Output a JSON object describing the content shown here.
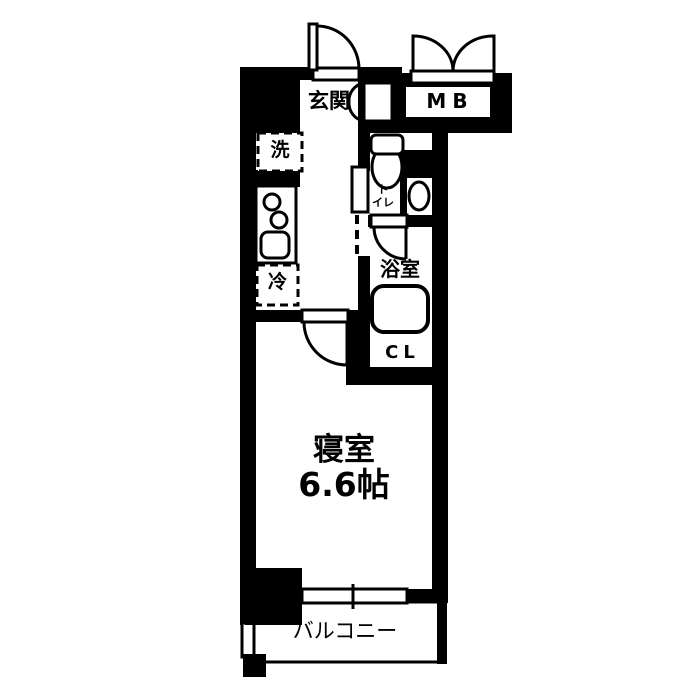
{
  "floorplan": {
    "type": "japanese-apartment-1k",
    "colors": {
      "wall": "#000000",
      "floor": "#ffffff",
      "line": "#000000"
    },
    "rooms": {
      "entrance": {
        "label": "玄関"
      },
      "meter_box": {
        "label": "MB"
      },
      "washer": {
        "label": "洗"
      },
      "fridge": {
        "label": "冷"
      },
      "toilet": {
        "label": "ト\nイレ"
      },
      "bathroom": {
        "label": "浴室"
      },
      "closet": {
        "label": "CL"
      },
      "bedroom": {
        "label": "寝室",
        "size": "6.6帖"
      },
      "balcony": {
        "label": "バルコニー"
      }
    },
    "fixtures": [
      "entrance-swing-door",
      "shoe-cabinet-double-door",
      "meter-box-double-door",
      "washing-machine-space",
      "kitchen-two-burner-stove",
      "kitchen-sink",
      "refrigerator-space",
      "toilet-bowl",
      "toilet-hand-basin",
      "bathroom-swing-door",
      "bathtub",
      "bedroom-swing-door",
      "sliding-window",
      "pillar",
      "balcony-partition"
    ]
  }
}
